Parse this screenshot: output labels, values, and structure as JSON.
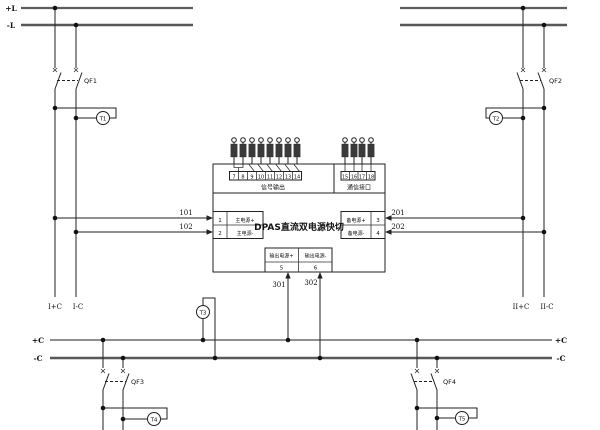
{
  "canvas": {
    "bg": "#ffffff",
    "wire_color": "#222222",
    "bus_color": "#5e5e5e"
  },
  "buses": {
    "top_left_plus": "+L",
    "top_left_minus": "-L",
    "bottom_left_plus": "+C",
    "bottom_left_minus": "-C",
    "bottom_right_plus": "+C",
    "bottom_right_minus": "-C"
  },
  "breakers": {
    "qf1": "QF1",
    "qf2": "QF2",
    "qf3": "QF3",
    "qf4": "QF4"
  },
  "monitors": {
    "t1": "T1",
    "t2": "T2",
    "t3": "T3",
    "t4": "T4",
    "t5": "T5"
  },
  "wires": {
    "main_plus": "101",
    "main_minus": "102",
    "backup_plus": "201",
    "backup_minus": "202",
    "out_plus": "301",
    "out_minus": "302"
  },
  "drops": {
    "sec1_plus": "I+C",
    "sec1_minus": "I-C",
    "sec2_plus": "II+C",
    "sec2_minus": "II-C"
  },
  "device": {
    "title": "DPAS直流双电源快切",
    "left_terminals": {
      "row1_num": "1",
      "row1_label": "主电源+",
      "row2_num": "2",
      "row2_label": "主电源-"
    },
    "right_terminals": {
      "row1_label": "备电源+",
      "row1_num": "3",
      "row2_label": "备电源-",
      "row2_num": "4"
    },
    "output_terminals": {
      "plus_label": "输出电源+",
      "plus_num": "5",
      "minus_label": "输出电源-",
      "minus_num": "6"
    },
    "signal_section": {
      "label": "信号输出",
      "numbers": [
        "7",
        "8",
        "9",
        "10",
        "11",
        "12",
        "13",
        "14"
      ]
    },
    "comm_section": {
      "label": "通信接口",
      "numbers": [
        "15",
        "16",
        "17",
        "18"
      ]
    }
  }
}
